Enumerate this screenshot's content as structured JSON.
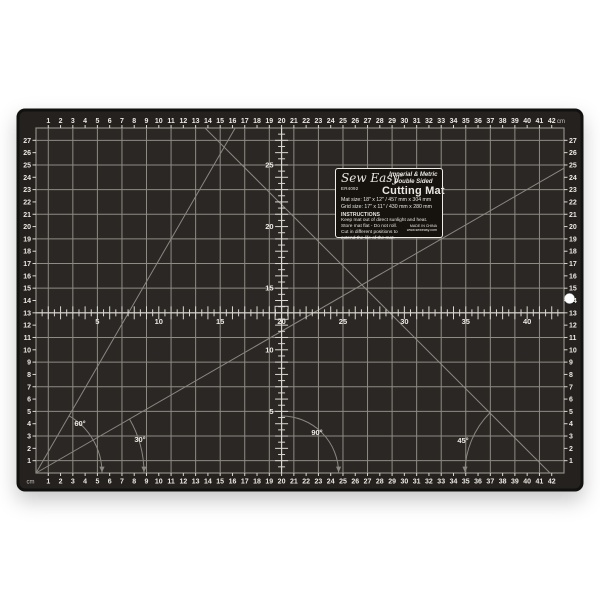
{
  "colors": {
    "background": "#ffffff",
    "mat": "#25211e",
    "mat_edge": "#111110",
    "grid_bg": "#2b2724",
    "grid_line": "#8e8b83",
    "ruler_line": "#d9d7d0",
    "number_text": "#eceae4",
    "diagonal_line": "#8a8781",
    "unit_text": "#c6c4be",
    "label_bg": "#16130f",
    "label_border": "#eeede7",
    "hole": "#ffffff"
  },
  "rulers": {
    "unit": "cm",
    "horizontal_numbers": [
      1,
      2,
      3,
      4,
      5,
      6,
      7,
      8,
      9,
      10,
      11,
      12,
      13,
      14,
      15,
      16,
      17,
      18,
      19,
      20,
      21,
      22,
      23,
      24,
      25,
      26,
      27,
      28,
      29,
      30,
      31,
      32,
      33,
      34,
      35,
      36,
      37,
      38,
      39,
      40,
      41,
      42
    ],
    "vertical_numbers": [
      1,
      2,
      3,
      4,
      5,
      6,
      7,
      8,
      9,
      10,
      11,
      12,
      13,
      14,
      15,
      16,
      17,
      18,
      19,
      20,
      21,
      22,
      23,
      24,
      25,
      26,
      27
    ],
    "center_horizontal_labels": [
      5,
      10,
      15,
      20,
      25,
      30,
      35,
      40
    ],
    "center_vertical_labels": [
      5,
      10,
      15,
      20,
      25
    ]
  },
  "angles": [
    {
      "id": "60",
      "text": "60°"
    },
    {
      "id": "30",
      "text": "30°"
    },
    {
      "id": "90",
      "text": "90°"
    },
    {
      "id": "45",
      "text": "45°"
    }
  ],
  "label": {
    "brand": "Sew Easy",
    "registered": "®",
    "sku": "ER4092",
    "tagline1": "Imperial & Metric",
    "tagline2": "Double Sided",
    "product": "Cutting Mat",
    "mat_size": "Mat size: 18\" x 12\" / 457 mm x 304 mm",
    "grid_size": "Grid size: 17\" x 11\" / 430 mm x 280 mm",
    "instructions_heading": "INSTRUCTIONS",
    "instructions": [
      "Keep mat out of direct sunlight and heat.",
      "Store mat flat - Do not roll.",
      "Cut in different positions to",
      "extend the life of the mat."
    ],
    "made_in": "MADE IN CHINA",
    "website": "www.seweasy.com"
  }
}
